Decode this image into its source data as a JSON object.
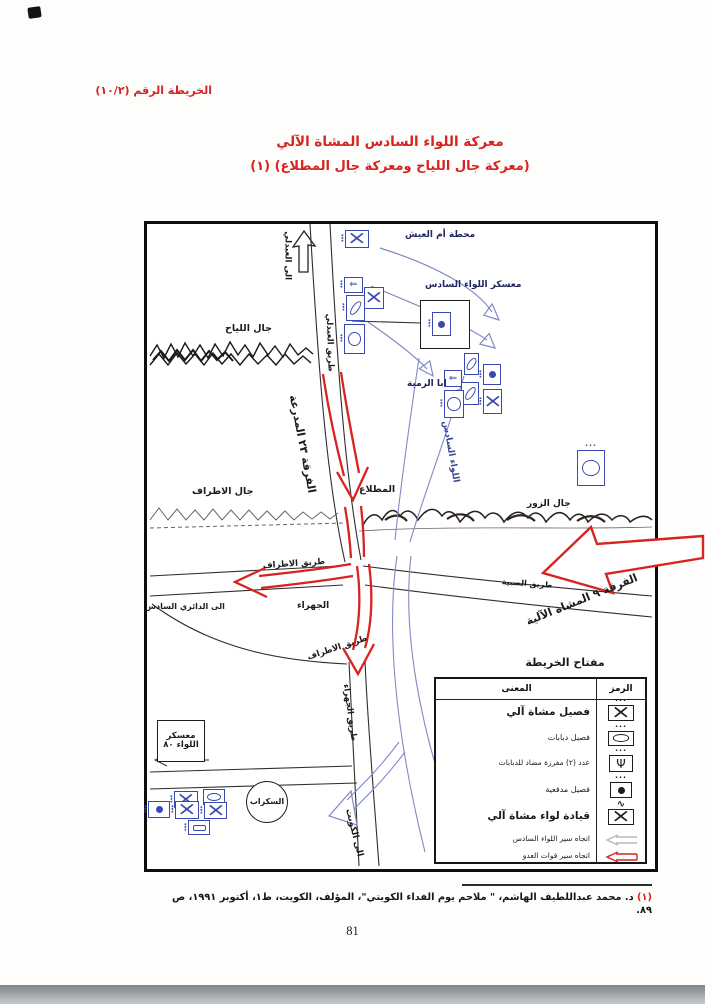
{
  "header": {
    "map_ref": "الخريطة الرقم (١٠/٢)"
  },
  "title": {
    "line1": "معركة اللواء السادس المشاة الآلي",
    "line2": "(معركة جال اللياح ومعركة جال المطلاع) (١)"
  },
  "map": {
    "places": {
      "to_abdali": "الى العبدلي",
      "abdali_road": "طريق العبدلي",
      "umm_aish_station": "محطة أم العيش",
      "sixth_brigade_camp": "معسكر اللواء السادس",
      "jal_liyah": "جال اللياح",
      "aba_rumiya": "ابا الرمية",
      "sixth_brigade_route": "اللواء السادس",
      "jal_atraf": "جال الاطراف",
      "mutlaa": "المطلاع",
      "jal_zor": "جال الزور",
      "atraf_road_upper": "طريق الاطراف",
      "atraf_road_lower": "طريق الاطراف",
      "subiya_road": "طريق الصبية",
      "to_sixth_ring": "الى الدائري السادس",
      "jahra": "الجهراء",
      "jahra_road": "طريق الجهراء",
      "to_kuwait": "الى الكويت",
      "brigade80_camp_line1": "معسكر",
      "brigade80_camp_line2": "اللواء ٨٠",
      "scrap_yard": "السكراب"
    },
    "forces": {
      "division23": "الفرقة ٢٣ المدرعة",
      "division9": "الفرقة ٩ المشاة الآلية"
    },
    "legend": {
      "title": "مفتاح الخريطة",
      "symbol_col": "الرمز",
      "meaning_col": "المعنى",
      "rows": [
        {
          "symbol": "mechanized-infantry-platoon",
          "meaning": "فصيل مشاة آلي"
        },
        {
          "symbol": "tank-platoon",
          "meaning": "فصيل دبابات"
        },
        {
          "symbol": "anti-tank-detachment",
          "meaning": "عدد (٢) مفرزة مضاد للدبابات"
        },
        {
          "symbol": "artillery-platoon",
          "meaning": "فصيل مدفعية"
        },
        {
          "symbol": "mechanized-infantry-brigade-hq",
          "meaning": "قيادة لواء مشاة آلي"
        },
        {
          "symbol": "sixth-brigade-route-arrow",
          "meaning": "اتجاه سير اللواء السادس"
        },
        {
          "symbol": "enemy-forces-route-arrow",
          "meaning": "اتجاه سير قوات العدو"
        }
      ]
    }
  },
  "footnote": {
    "marker": "(١)",
    "text": "د. محمد عبداللطيف الهاشم، \" ملاحم يوم الفداء الكويتي\"، المؤلف، الكويت، ط١، أكتوبر ١٩٩١، ص ٨٩."
  },
  "page_number": "81",
  "colors": {
    "accent_red": "#d8231f",
    "unit_blue": "#3a49b0",
    "route_blue": "#8089c6"
  }
}
